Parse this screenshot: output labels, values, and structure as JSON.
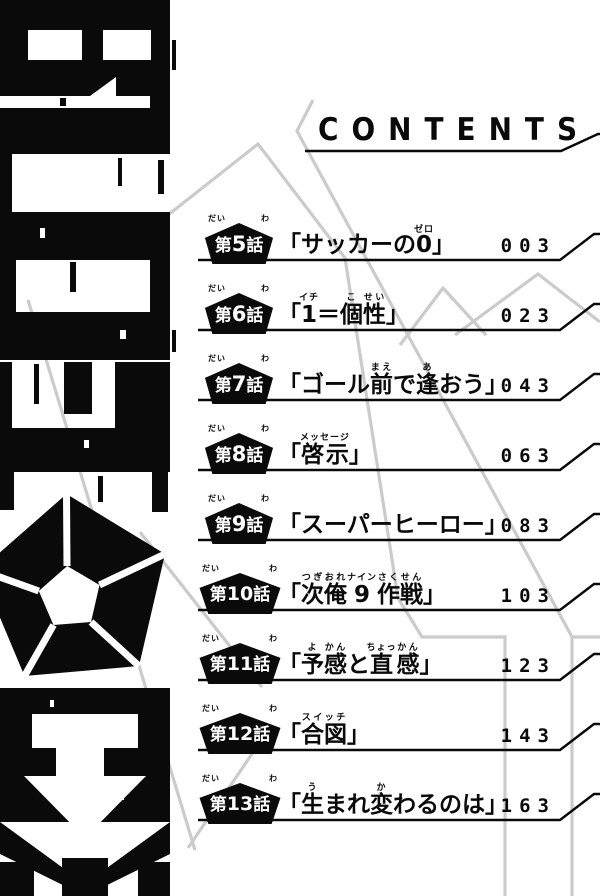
{
  "header": {
    "title": "CONTENTS"
  },
  "logo": {
    "text": "BLUELOCK"
  },
  "colors": {
    "ink": "#0a0a0a",
    "gray_line": "#cbcbcb",
    "paper": "#ffffff"
  },
  "entries": [
    {
      "prefix": "第",
      "num": "5",
      "suffix": "話",
      "prefix_furi": "だい",
      "suffix_furi": "わ",
      "page": "003",
      "title_segments": [
        {
          "t": "「サッカーの"
        },
        {
          "t": "0",
          "r": "ゼロ"
        },
        {
          "t": "」"
        }
      ]
    },
    {
      "prefix": "第",
      "num": "6",
      "suffix": "話",
      "prefix_furi": "だい",
      "suffix_furi": "わ",
      "page": "023",
      "title_segments": [
        {
          "t": "「"
        },
        {
          "t": "1",
          "r": "イチ"
        },
        {
          "t": "＝"
        },
        {
          "t": "個",
          "r": "こ"
        },
        {
          "t": "性",
          "r": "せい"
        },
        {
          "t": "」"
        }
      ]
    },
    {
      "prefix": "第",
      "num": "7",
      "suffix": "話",
      "prefix_furi": "だい",
      "suffix_furi": "わ",
      "page": "043",
      "title_segments": [
        {
          "t": "「ゴール"
        },
        {
          "t": "前",
          "r": "まえ"
        },
        {
          "t": "で"
        },
        {
          "t": "逢",
          "r": "あ"
        },
        {
          "t": "おう」"
        }
      ]
    },
    {
      "prefix": "第",
      "num": "8",
      "suffix": "話",
      "prefix_furi": "だい",
      "suffix_furi": "わ",
      "page": "063",
      "title_segments": [
        {
          "t": "「"
        },
        {
          "t": "啓示",
          "r": "メッセージ"
        },
        {
          "t": "」"
        }
      ]
    },
    {
      "prefix": "第",
      "num": "9",
      "suffix": "話",
      "prefix_furi": "だい",
      "suffix_furi": "わ",
      "page": "083",
      "title_segments": [
        {
          "t": "「スーパーヒーロー」"
        }
      ]
    },
    {
      "prefix": "第",
      "num": "10",
      "suffix": "話",
      "prefix_furi": "だい",
      "suffix_furi": "わ",
      "page": "103",
      "title_segments": [
        {
          "t": "「"
        },
        {
          "t": "次",
          "r": "つぎ"
        },
        {
          "t": "俺",
          "r": "おれ"
        },
        {
          "t": "9",
          "r": "ナイン"
        },
        {
          "t": "作",
          "r": "さく"
        },
        {
          "t": "戦",
          "r": "せん"
        },
        {
          "t": "」"
        }
      ]
    },
    {
      "prefix": "第",
      "num": "11",
      "suffix": "話",
      "prefix_furi": "だい",
      "suffix_furi": "わ",
      "page": "123",
      "title_segments": [
        {
          "t": "「"
        },
        {
          "t": "予",
          "r": "よ"
        },
        {
          "t": "感",
          "r": "かん"
        },
        {
          "t": "と"
        },
        {
          "t": "直",
          "r": "ちょっ"
        },
        {
          "t": "感",
          "r": "かん"
        },
        {
          "t": "」"
        }
      ]
    },
    {
      "prefix": "第",
      "num": "12",
      "suffix": "話",
      "prefix_furi": "だい",
      "suffix_furi": "わ",
      "page": "143",
      "title_segments": [
        {
          "t": "「"
        },
        {
          "t": "合図",
          "r": "スイッチ"
        },
        {
          "t": "」"
        }
      ]
    },
    {
      "prefix": "第",
      "num": "13",
      "suffix": "話",
      "prefix_furi": "だい",
      "suffix_furi": "わ",
      "page": "163",
      "title_segments": [
        {
          "t": "「"
        },
        {
          "t": "生",
          "r": "う"
        },
        {
          "t": "まれ"
        },
        {
          "t": "変",
          "r": "か"
        },
        {
          "t": "わるのは」"
        }
      ]
    }
  ]
}
